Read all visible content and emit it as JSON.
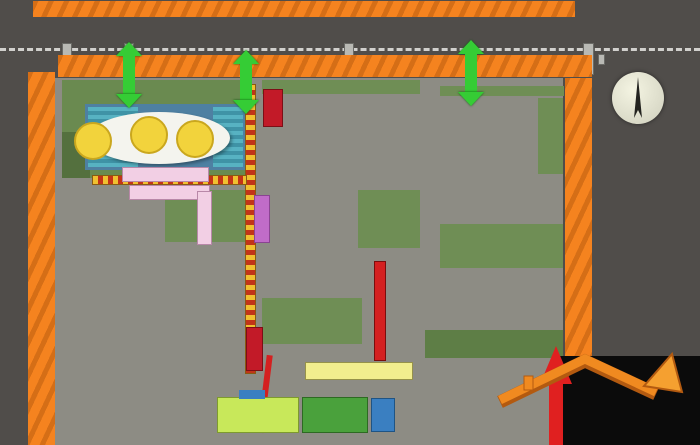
{
  "title": "2016 年中国大同工业时代音乐节场地图",
  "parking": {
    "label": "停车位"
  },
  "compass": {
    "north": "N"
  },
  "map": {
    "entrance_label": "出入口",
    "rv_chars": [
      "房",
      "车",
      "区"
    ],
    "ticket_office": "售票处",
    "ticket_check": "检票处",
    "outer_zone": "外展区",
    "lantern_zone": "彩灯区",
    "inner_zone": "内展区",
    "carnival_zone": "嘉年华区",
    "main_venue": "主会场",
    "stage": "舞台",
    "sub_stage": "副舞台",
    "actor_path": "演员通道",
    "markers": [
      "2",
      "4",
      "5",
      "6",
      "7",
      "9"
    ]
  },
  "legend": {
    "items": [
      {
        "label": "售票处",
        "type": "solid",
        "color": "#b51a28"
      },
      {
        "label": "外展通道",
        "type": "dashed",
        "color": "#f0c030"
      },
      {
        "label": "主舞台",
        "type": "solid",
        "color": "#4a9ad4"
      },
      {
        "label": "嘉年华区",
        "type": "solid",
        "color": "#bfe35e"
      },
      {
        "label": "副舞台",
        "type": "solid",
        "color": "#4a9ad4"
      },
      {
        "label": "主会场",
        "type": "solid",
        "color": "#7ccb4a"
      },
      {
        "label": "内展区",
        "type": "solid",
        "color": "#f1ee8b"
      },
      {
        "label": "演员通道",
        "type": "solid",
        "color": "#e8231e"
      },
      {
        "label": "灯盏区",
        "type": "solid",
        "color": "#c06cc8"
      },
      {
        "label": "外展区",
        "type": "solid",
        "color": "#49a849"
      },
      {
        "label": "停车场",
        "type": "solid",
        "color": "#f5831f"
      },
      {
        "label": "大巴车",
        "type": "bus",
        "color": "#b51a28"
      },
      {
        "label": "应急出口",
        "type": "exit",
        "color": "#14421a"
      }
    ]
  },
  "logo": {
    "number": "0352",
    "name": "房网",
    "url": "www.0352fang.com"
  }
}
